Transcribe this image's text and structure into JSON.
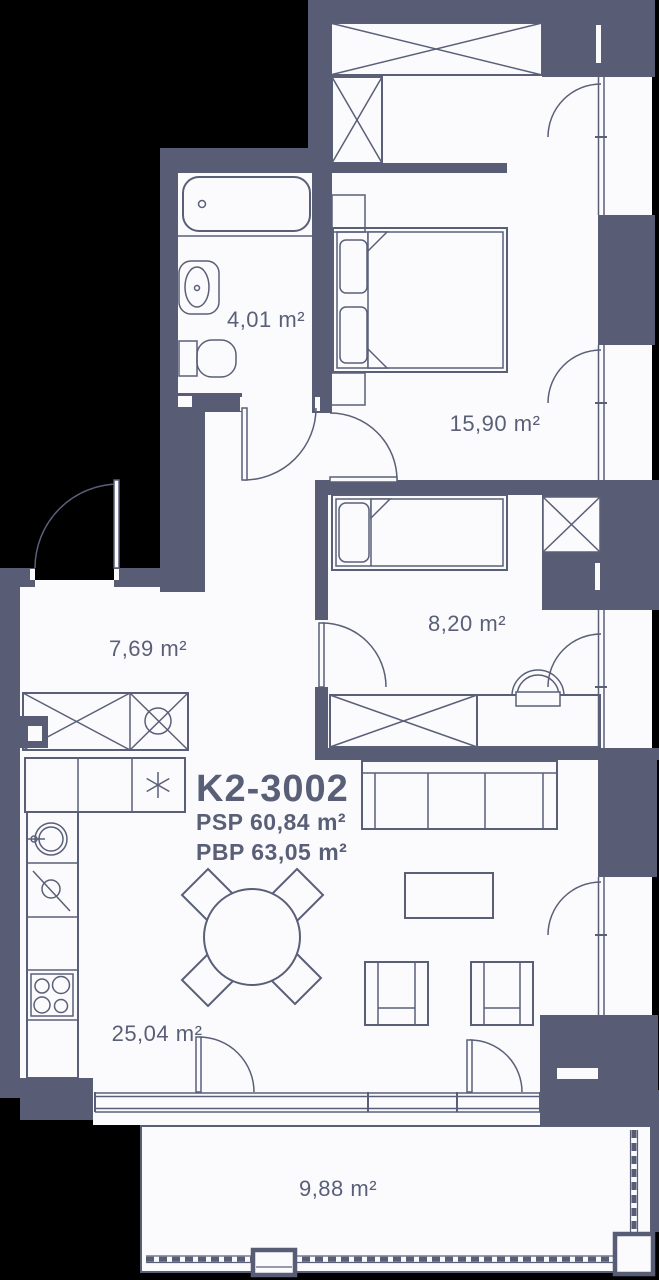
{
  "unit": {
    "code": "K2-3002",
    "psp": "PSP 60,84 m²",
    "pbp": "PBP 63,05 m²"
  },
  "rooms": {
    "bathroom": {
      "area": "4,01 m²"
    },
    "bedroom": {
      "area": "15,90 m²"
    },
    "hallway": {
      "area": "7,69 m²"
    },
    "bedroom2": {
      "area": "8,20 m²"
    },
    "living": {
      "area": "25,04 m²"
    },
    "terrace": {
      "area": "9,88 m²"
    }
  },
  "colors": {
    "wall": "#585C74",
    "line": "#5A5F78",
    "ink": "#5A5F78",
    "floor": "#FBFBFD",
    "bg": "#000000"
  }
}
